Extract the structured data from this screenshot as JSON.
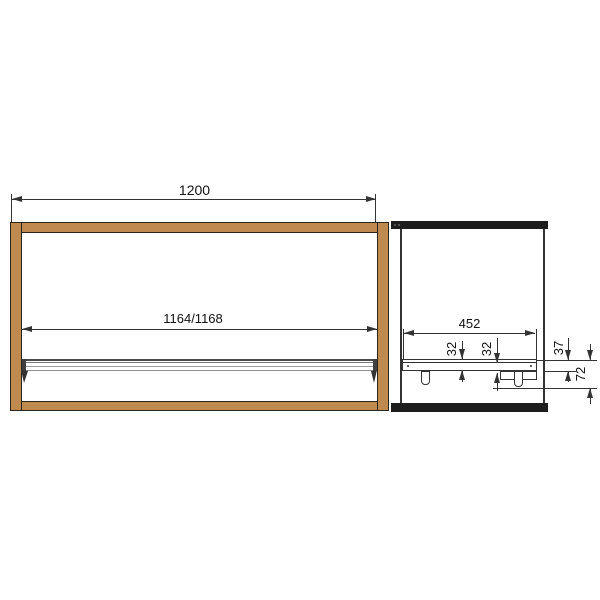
{
  "drawing": {
    "title": "wardrobe-rail-technical-drawing",
    "front_view": {
      "outer_width_label": "1200",
      "rail_length_label": "1164/1168"
    },
    "side_view": {
      "depth_label": "452",
      "offset_label_1": "32",
      "offset_label_2": "32",
      "height_label_1": "37",
      "height_label_2": "72"
    },
    "colors": {
      "wood": "#bf8a50",
      "line": "#333333",
      "dark_panel": "#1d1d1d",
      "rail_gray": "#9a9a9a",
      "background": "#ffffff"
    }
  }
}
